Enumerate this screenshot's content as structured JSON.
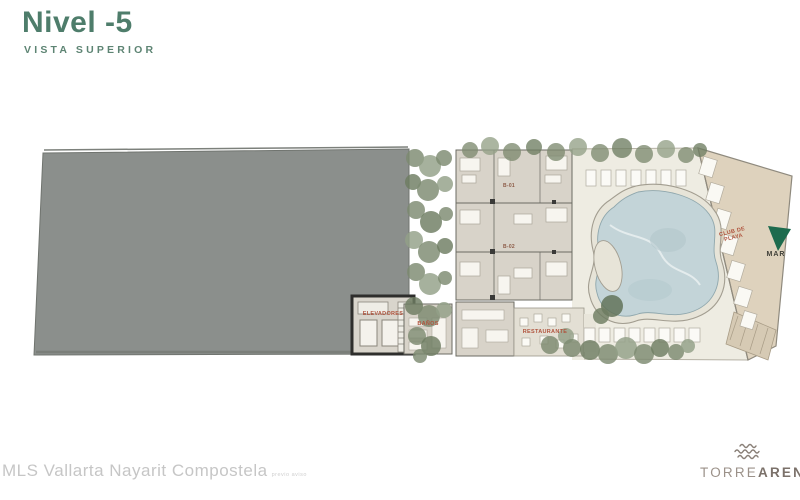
{
  "header": {
    "title": "Nivel -5",
    "subtitle": "VISTA SUPERIOR"
  },
  "plan": {
    "units": [
      {
        "label": "B-01"
      },
      {
        "label": "B-02"
      }
    ],
    "areas": {
      "elevators": "ELEVADORES",
      "bathrooms": "BAÑOS",
      "restaurant": "RESTAURANTE",
      "beach_club_line1": "CLUB DE",
      "beach_club_line2": "PLAYA",
      "sea": "MAR"
    }
  },
  "watermark": {
    "text": "MLS Vallarta Nayarit Compostela",
    "small_text": "previo aviso"
  },
  "brand": {
    "name_light": "TORRE",
    "name_bold": "ARENA"
  },
  "colors": {
    "title_green": "#4e7d6b",
    "label_red": "#b0543e",
    "slab_gray": "#8b8f8c",
    "floor_beige": "#d8d3c9",
    "deck_light": "#eeece2",
    "pool_blue": "#c3d4d8",
    "sand_tan": "#ded2bd",
    "tree_green": "#7d8a70",
    "sea_arrow_green": "#1d6b4e",
    "brand_gray": "#8a8078"
  }
}
